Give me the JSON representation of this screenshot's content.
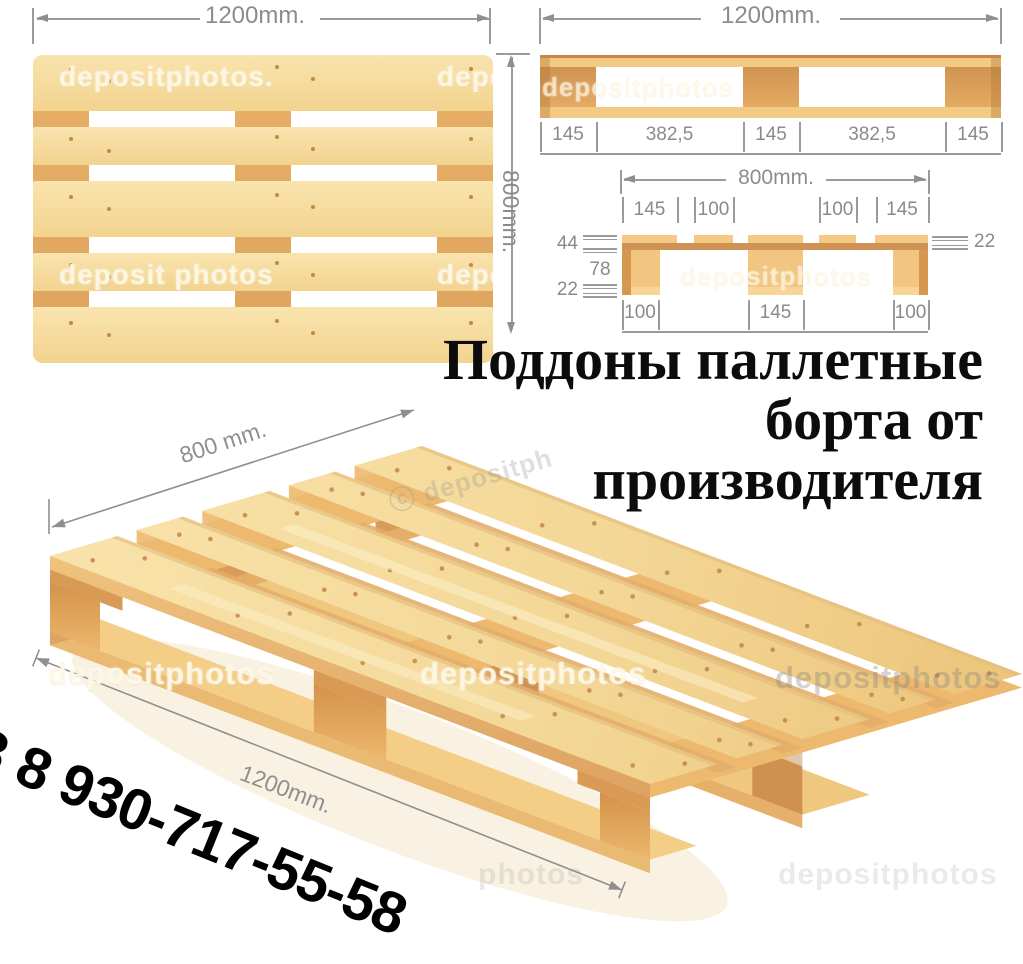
{
  "headline": {
    "line1": "Поддоны паллетные",
    "line2": "борта от",
    "line3": "производителя"
  },
  "phone": {
    "clipped_prefix": "8",
    "number": "8 930-717-55-58"
  },
  "watermark": {
    "full": "depositphotos",
    "dotted": "depositphotos.",
    "spaced": "deposit photos",
    "partial": "depos",
    "partial2": "depositph",
    "photos": "photos",
    "copyright": "ⓒ"
  },
  "views": {
    "top": {
      "width_label": "1200mm.",
      "height_label": "800mm."
    },
    "side": {
      "width_label": "1200mm.",
      "measures": [
        "145",
        "382,5",
        "145",
        "382,5",
        "145"
      ]
    },
    "end": {
      "width_label": "800mm.",
      "top_measures": [
        "145",
        "100",
        "100",
        "145"
      ],
      "left_measures": [
        "44",
        "78",
        "22"
      ],
      "right_measure": "22",
      "bottom_measures": [
        "100",
        "145",
        "100"
      ]
    },
    "iso": {
      "depth_label": "800 mm.",
      "length_label": "1200mm."
    }
  },
  "colors": {
    "wood_light": "#f6dfa2",
    "wood_medium": "#e9b066",
    "wood_band": "#cf9257",
    "wood_block_dark": "#d6974f",
    "dimension_gray": "#8c8c8c",
    "headline_black": "#0c0c0c",
    "background": "#ffffff"
  }
}
